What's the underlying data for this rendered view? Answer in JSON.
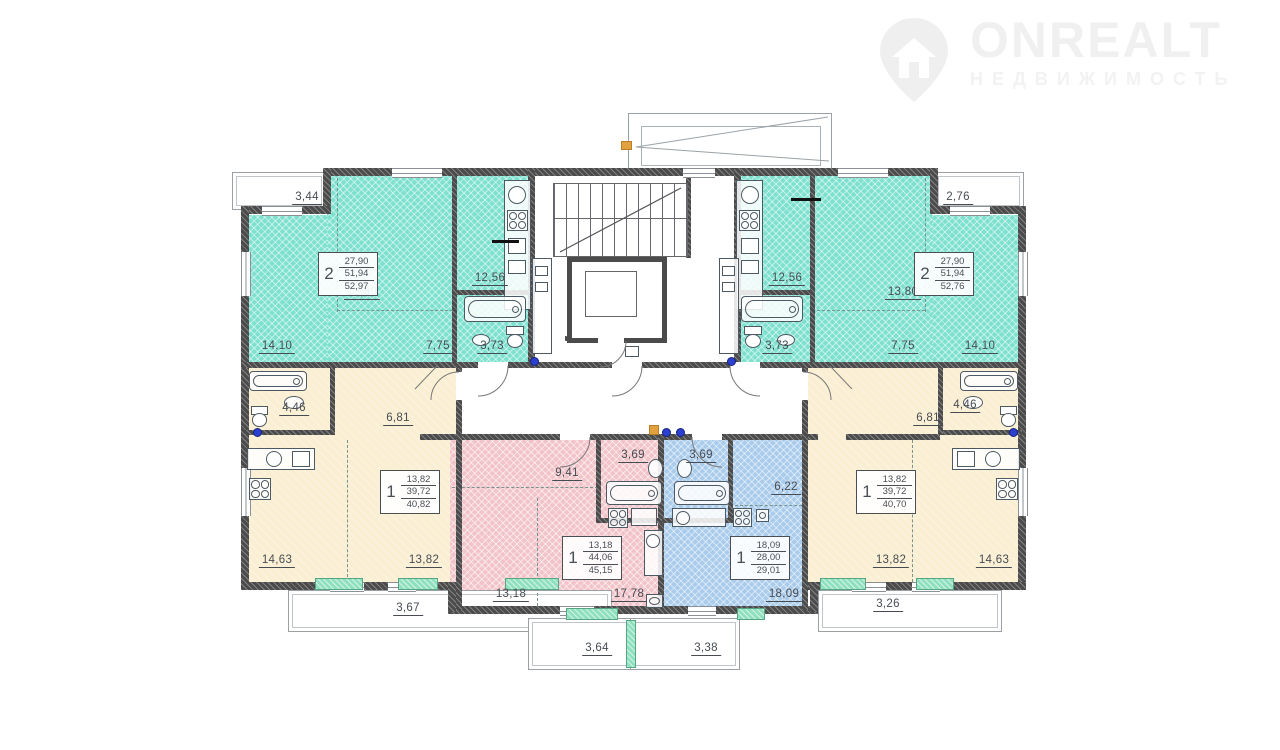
{
  "logo": {
    "brand": "ONREALT",
    "subtitle": "НЕДВИЖИМОСТЬ"
  },
  "palette": {
    "teal": "#7EE1D0",
    "cream": "#FBEFD3",
    "pink": "#F2C3C8",
    "blue": "#A9CBEC",
    "wall": "#4B4B4B",
    "dim_text": "#474C52",
    "plumbing_dot": "#2B3FD0",
    "sill_green": "#8FE0BE"
  },
  "apartments": [
    {
      "id": "apt-2-top-left",
      "type_label": "2",
      "color": "teal",
      "area_living": "27,90",
      "area_main": "51,94",
      "area_total": "52,97",
      "rooms": [
        "14,10",
        "13,80",
        "12,56",
        "7,75",
        "3,73"
      ],
      "balcony": "3,44"
    },
    {
      "id": "apt-2-top-right",
      "type_label": "2",
      "color": "teal",
      "area_living": "27,90",
      "area_main": "51,94",
      "area_total": "52,76",
      "rooms": [
        "12,56",
        "13,80",
        "3,73",
        "7,75",
        "14,10"
      ],
      "balcony": "2,76"
    },
    {
      "id": "apt-1-left",
      "type_label": "1",
      "color": "cream",
      "area_living": "13,82",
      "area_main": "39,72",
      "area_total": "40,82",
      "rooms": [
        "4,46",
        "6,81",
        "14,63",
        "13,82"
      ],
      "balcony": "3,67"
    },
    {
      "id": "apt-1-center-left",
      "type_label": "1",
      "color": "pink",
      "area_living": "13,18",
      "area_main": "44,06",
      "area_total": "45,15",
      "rooms": [
        "9,41",
        "3,69",
        "13,18",
        "17,78"
      ],
      "balcony": "3,64"
    },
    {
      "id": "apt-1-center-right",
      "type_label": "1",
      "color": "blue",
      "area_living": "18,09",
      "area_main": "28,00",
      "area_total": "29,01",
      "rooms": [
        "3,69",
        "6,22",
        "18,09"
      ],
      "balcony": "3,38"
    },
    {
      "id": "apt-1-right",
      "type_label": "1",
      "color": "cream",
      "area_living": "13,82",
      "area_main": "39,72",
      "area_total": "40,70",
      "rooms": [
        "6,81",
        "4,46",
        "13,82",
        "14,63"
      ],
      "balcony": "3,26"
    }
  ],
  "dims": [
    "3,44",
    "13,80",
    "12,56",
    "14,10",
    "7,75",
    "3,73",
    "2,76",
    "12,56",
    "13,80",
    "3,73",
    "7,75",
    "14,10",
    "4,46",
    "6,81",
    "14,63",
    "13,82",
    "3,67",
    "9,41",
    "3,69",
    "13,18",
    "17,78",
    "3,64",
    "3,69",
    "6,22",
    "18,09",
    "3,38",
    "6,81",
    "4,46",
    "13,82",
    "14,63",
    "3,26"
  ]
}
